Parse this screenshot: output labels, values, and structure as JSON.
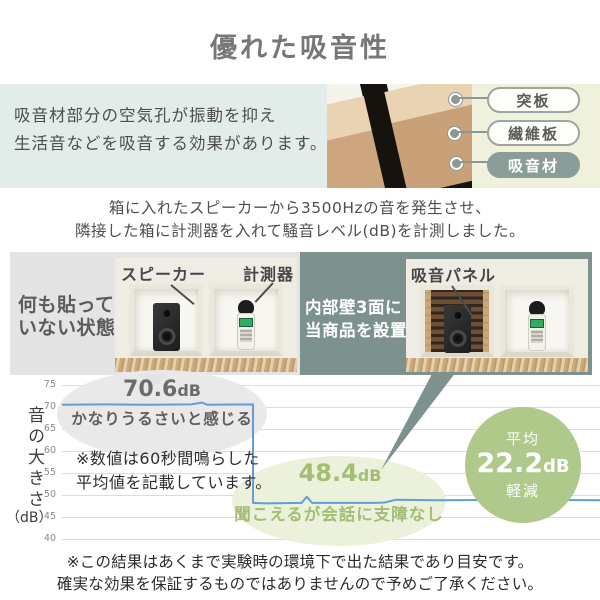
{
  "title": "優れた吸音性",
  "intro": {
    "line1": "吸音材部分の空気孔が振動を抑え",
    "line2": "生活音などを吸音する効果があります。",
    "labels": [
      {
        "text": "突板",
        "filled": false
      },
      {
        "text": "繊維板",
        "filled": false
      },
      {
        "text": "吸音材",
        "filled": true
      }
    ]
  },
  "experiment": {
    "desc_line1": "箱に入れたスピーカーから3500Hzの音を発生させ、",
    "desc_line2": "隣接した箱に計測器を入れて騒音レベル(dB)を計測しました。",
    "before": {
      "label_line1": "何も貼って",
      "label_line2": "いない状態",
      "speaker_label": "スピーカー",
      "meter_label": "計測器"
    },
    "after": {
      "label_line1": "内部壁3面に",
      "label_line2": "当商品を設置",
      "panel_label": "吸音パネル"
    }
  },
  "results": {
    "before": {
      "value": "70.6",
      "unit": "dB",
      "caption": "かなりうるさいと感じる"
    },
    "after": {
      "value": "48.4",
      "unit": "dB",
      "caption": "聞こえるが会話に支障なし"
    },
    "note_line1": "※数値は60秒間鳴らした",
    "note_line2": "平均値を記載しています。",
    "badge": {
      "top": "平均",
      "value": "22.2",
      "unit": "dB",
      "bottom": "軽減"
    }
  },
  "footer": {
    "line1": "※この結果はあくまで実験時の環境下で出た結果であり目安です。",
    "line2": "確実な効果を保証するものではありませんので予めご了承ください。"
  },
  "chart_data": {
    "type": "line",
    "ylabel": "音の大きさ（dB）",
    "ylabel_main": "音の大きさ",
    "ylabel_unit": "（dB）",
    "xlabel": "",
    "ylim": [
      40,
      75
    ],
    "yticks": [
      75,
      70,
      65,
      60,
      55,
      50,
      45,
      40
    ],
    "grid": true,
    "line_color": "#5f9fd6",
    "series": [
      {
        "name": "騒音レベル(dB)",
        "points": [
          [
            0,
            70.5
          ],
          [
            8,
            70.6
          ],
          [
            16,
            70.5
          ],
          [
            24,
            70.6
          ],
          [
            26,
            71.0
          ],
          [
            27,
            70.5
          ],
          [
            35.5,
            70.6
          ],
          [
            35.5,
            48.2
          ],
          [
            38,
            48.1
          ],
          [
            44.5,
            48.2
          ],
          [
            45.5,
            49.6
          ],
          [
            46.5,
            48.2
          ],
          [
            58,
            48.2
          ],
          [
            60,
            48.3
          ],
          [
            62,
            48.9
          ],
          [
            70,
            48.8
          ],
          [
            85,
            48.9
          ],
          [
            100,
            48.8
          ]
        ]
      }
    ],
    "annotations": [
      {
        "label": "70.6dB",
        "caption": "かなりうるさいと感じる",
        "value": 70.6
      },
      {
        "label": "48.4dB",
        "caption": "聞こえるが会話に支障なし",
        "value": 48.4
      }
    ],
    "reduction": {
      "label": "平均",
      "value": 22.2,
      "unit": "dB",
      "suffix": "軽減"
    }
  },
  "colors": {
    "band_bg": "#e2ece8",
    "cream_bg": "#f0f1dd",
    "label_pill_fill": "#8b9d99",
    "before_box_bg": "#e4e4e4",
    "after_box_bg": "#7d918e",
    "chart_line": "#5f9fd6",
    "result_green": "#a2be74",
    "green_ellipse_bg": "#ecf1dc",
    "gray_ellipse_bg": "#e9e9e9",
    "badge_bg": "#aec989"
  }
}
